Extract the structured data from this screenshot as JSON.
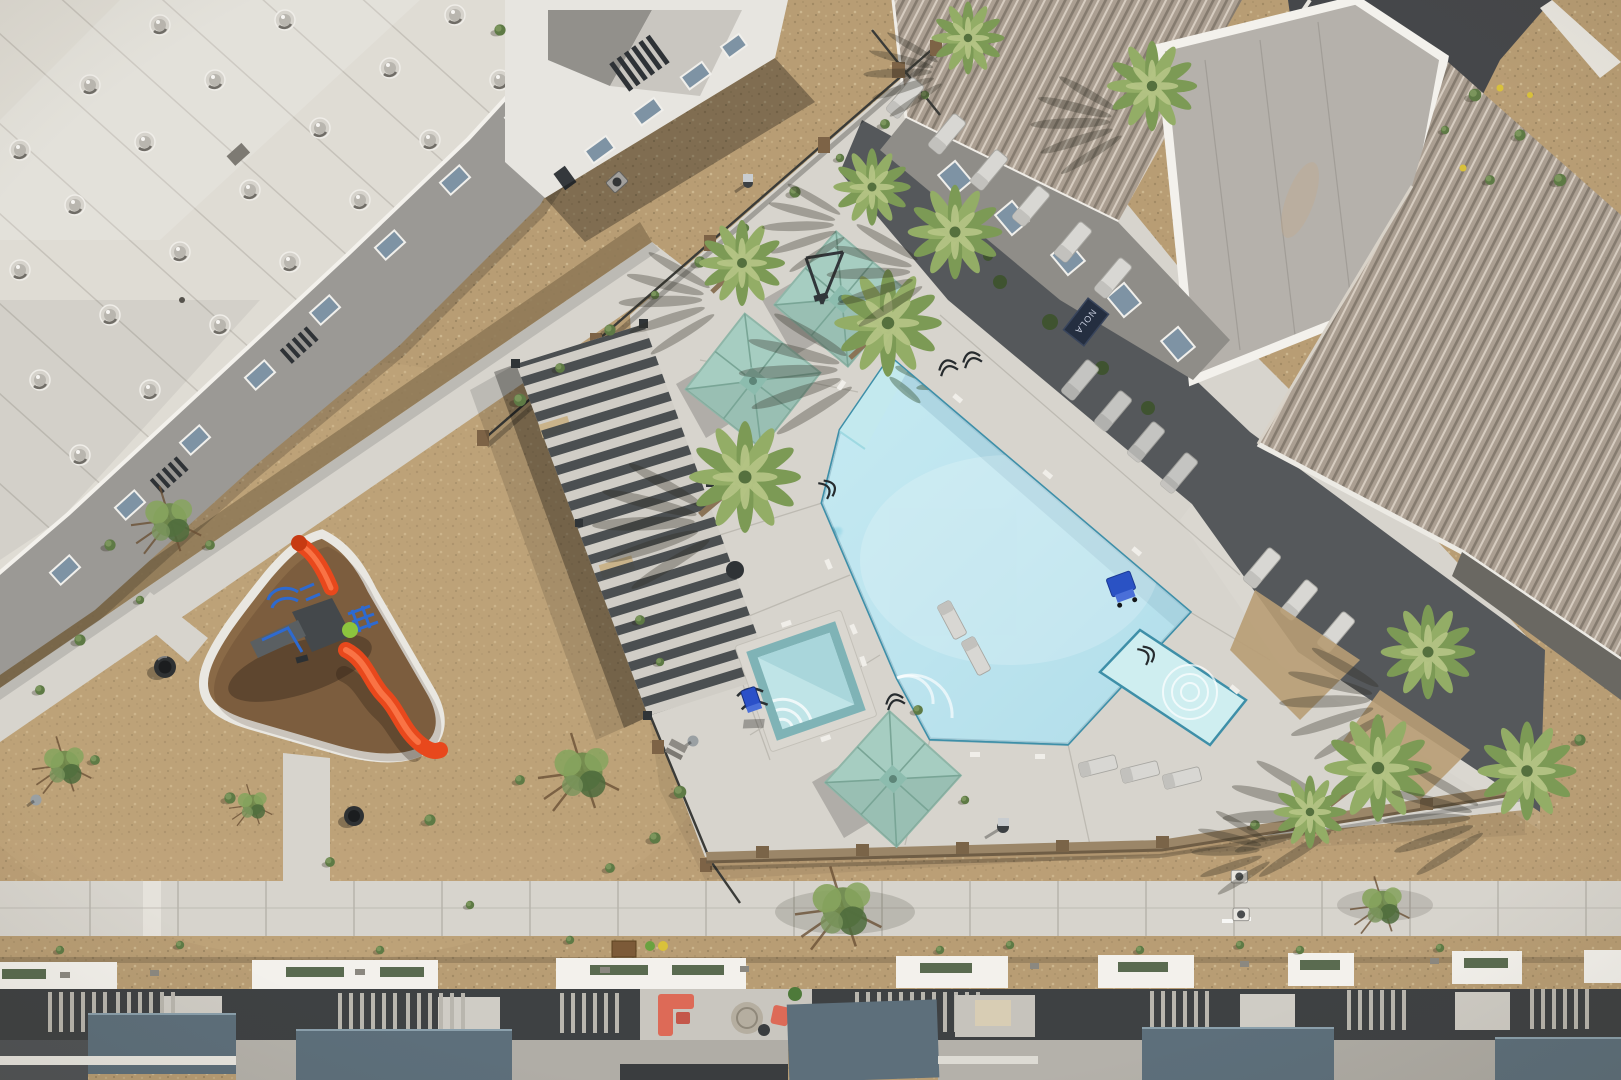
{
  "meta": {
    "title": "Aerial drone photo — apartment community courtyard with pool, pergola and playground",
    "type": "aerial-photograph",
    "visible_text_note": "The only legible text in the photo is the NOLA doormat at the clubhouse entrance."
  },
  "labels": {
    "clubhouse_mat": "NOLA"
  },
  "inventory": {
    "pool": "large pentagonal resort pool with tanning ledge, baja shelf and square spa",
    "umbrellas": 3,
    "palm_trees": 11,
    "desert_trees": 5,
    "lounge_chairs": 15,
    "playground_slides": 2,
    "trash_cans": 2,
    "buildings": "white-roof apartment block (NW), gray apartment block (N), clubhouse with ribbed metal roofs (NE), townhome row (S)",
    "ground": "desert gravel landscaping with concrete walkways and pool deck"
  },
  "palette": {
    "gravel": "#b89d74",
    "gravel_light": "#cdb086",
    "mulch": "#8d7856",
    "concrete": "#d7d4cd",
    "concrete_bright": "#e5e2db",
    "concrete_seam": "#b7b4ac",
    "charcoal": "#55585b",
    "asphalt": "#45474a",
    "roof_white": "#dfdcd4",
    "parapet": "#f3f1ec",
    "facade": "#9b9995",
    "window_glass": "#7e93a4",
    "rib_tan": "#ab9f92",
    "rib_dark": "#857b6f",
    "rib_light": "#d6ccc0",
    "flat_roof": "#b5b1ab",
    "metal_dark": "#3f4447",
    "fence": "#3a3b38",
    "brick": "#7d6346",
    "water": "#7ecbdf",
    "water_deep": "#5fb6cf",
    "ledge": "#c3e9ee",
    "coping": "#3e8fa8",
    "spa_tile": "#7fb3b6",
    "umbrella": "#a6cdc1",
    "umbrella_dark": "#8cbcae",
    "palm": "#7c9a55",
    "palm_light": "#b7c687",
    "shrub": "#5e7a45",
    "rubber": "#8a6a47",
    "slide": "#e8481c",
    "slide_light": "#f97345",
    "play_blue": "#2e6ad0",
    "play_green": "#8cc43e",
    "coral": "#dd6a57",
    "town_blue": "#5d6f7b",
    "town_charcoal": "#3e4143",
    "wall_tan": "#9b8668",
    "mat_navy": "#242e40",
    "lounger": "#d8d7d3"
  }
}
